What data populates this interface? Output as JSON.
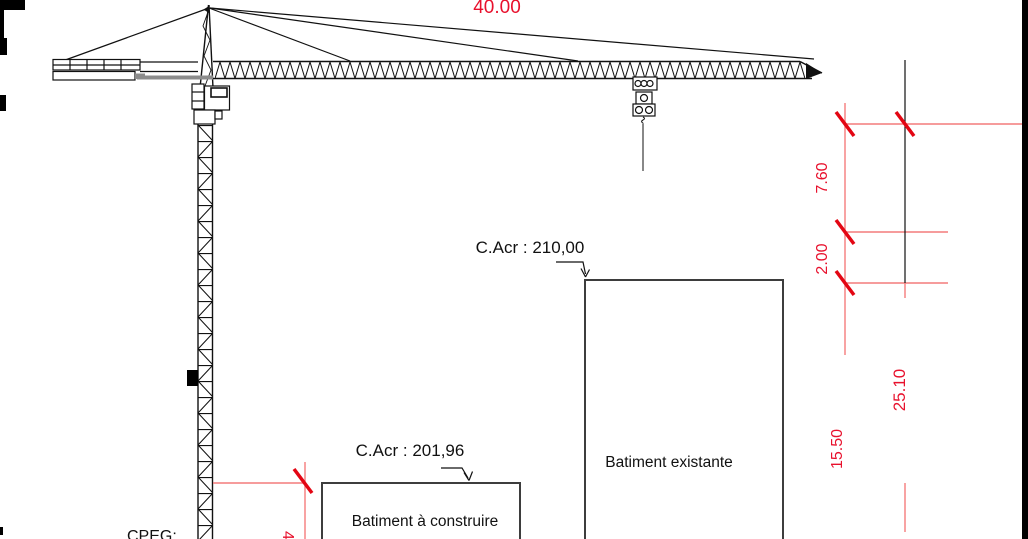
{
  "dimensions": {
    "jib_length": "40.00",
    "right_1": "7.60",
    "right_2": "2.00",
    "right_3": "25.10",
    "right_4": "15.50",
    "left_partial": "4.43"
  },
  "labels": {
    "acr_existing": "C.Acr : 210,00",
    "acr_new": "C.Acr : 201,96",
    "building_existing": "Batiment existante",
    "building_new": "Batiment à construire",
    "cpeg": "CPEG:"
  },
  "colors": {
    "dim_text_red": "#e8112d",
    "dim_line_red": "#f47c7c",
    "dim_tick_red": "#e30613",
    "drawing_black": "#111111",
    "machinery_gray": "#8c8c8c",
    "building_border": "#3d3d3d",
    "background": "#ffffff"
  }
}
